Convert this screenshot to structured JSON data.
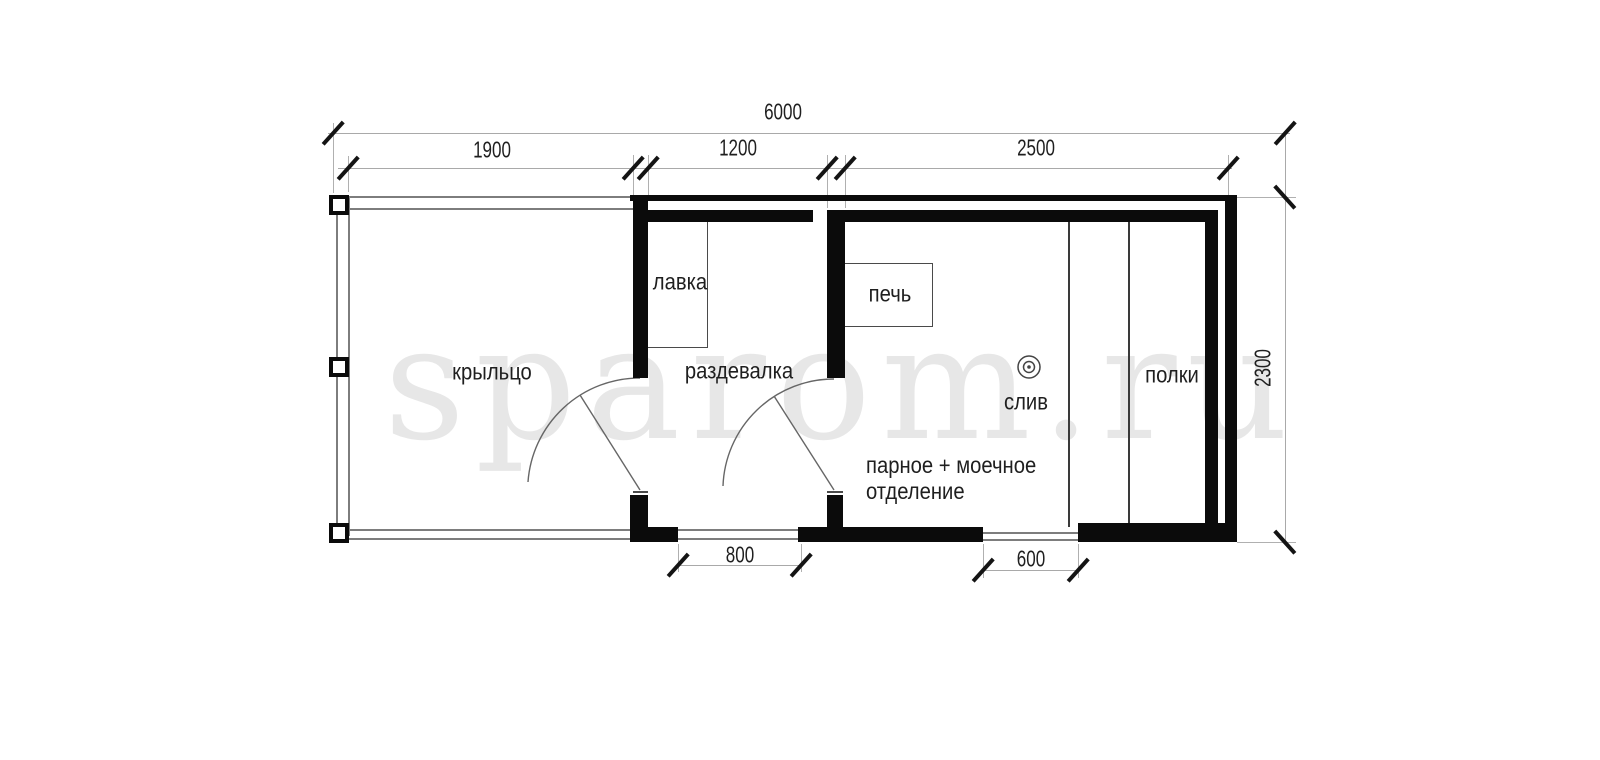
{
  "watermark": "sparom.ru",
  "plan_title": "floor plan of sauna 6000x2300",
  "rooms": {
    "porch_label": "крыльцо",
    "dressing_label": "раздевалка",
    "bench_label": "лавка",
    "stove_label": "печь",
    "drain_label": "слив",
    "shelves_label": "полки",
    "steam_label_line1": "парное + моечное",
    "steam_label_line2": "отделение"
  },
  "dimensions": {
    "total_width": "6000",
    "porch_width": "1900",
    "dressing_width": "1200",
    "steam_width": "2500",
    "building_depth": "2300",
    "entry_opening": "800",
    "side_opening": "600"
  },
  "colors": {
    "wall": "#0b0b0b",
    "dim_line": "#a9a9a9",
    "watermark": "#e7e7e7",
    "text": "#1f1f1f"
  }
}
